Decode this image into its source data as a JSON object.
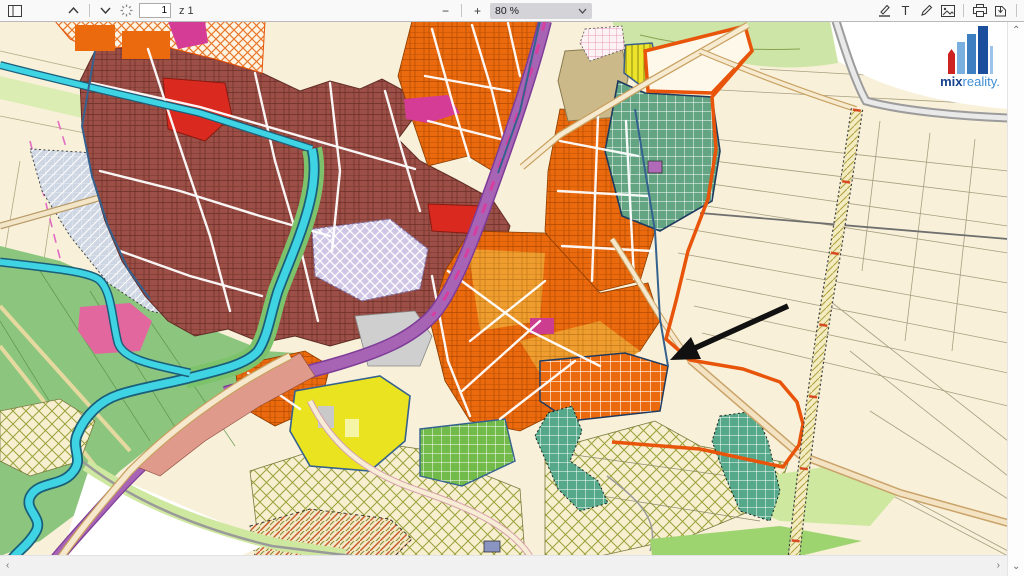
{
  "toolbar": {
    "page": {
      "current_value": "1",
      "total_label": "z 1"
    },
    "zoom": {
      "value": "80 %"
    },
    "glyphs": {
      "minus": "−",
      "plus": "+",
      "text_tool": "T",
      "more_tools": "»"
    }
  },
  "content": {
    "logo": {
      "brand_bold": "mix",
      "brand_light": "reality."
    },
    "annotation_arrow": {
      "shape": "arrow",
      "color": "#111111"
    },
    "map_colors": {
      "dark_brick": "#9c4f46",
      "orange": "#ec6a0e",
      "amber": "#f09d2f",
      "red": "#da2a20",
      "magenta": "#d53c96",
      "pink": "#e2679e",
      "lavender": "#cfc6e6",
      "sea_green_grid": "#63a583",
      "bright_green_grid": "#72ba4a",
      "teal_grid": "#55a98a",
      "farm_green": "#8cc67e",
      "pale_green": "#cde6a8",
      "cream_fields": "#f8f0d8",
      "water_cyan": "#3fd4e4",
      "purple_road": "#a864b4",
      "gray_blue_hatch": "#cdd6e2",
      "yellow": "#e9e41f",
      "tan_khaki": "#cbb98a",
      "boundary_orange": "#e8540a"
    }
  },
  "scrollbars": {
    "up": "⌃",
    "down": "⌄",
    "left": "‹",
    "right": "›"
  }
}
